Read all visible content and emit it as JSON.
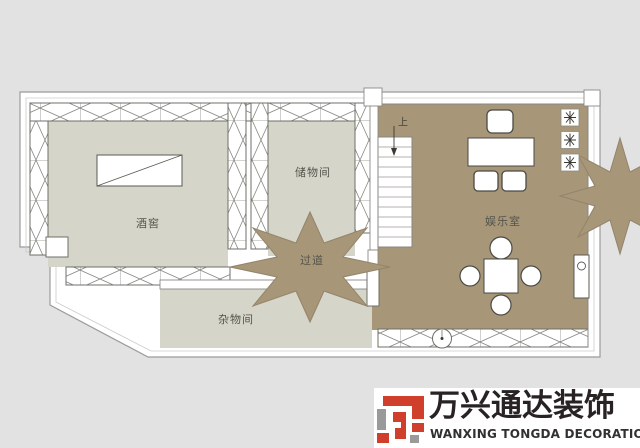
{
  "floorplan": {
    "rooms": [
      {
        "name": "wine-cellar",
        "label": "酒窖"
      },
      {
        "name": "storage-room",
        "label": "储物间"
      },
      {
        "name": "hallway",
        "label": "过道"
      },
      {
        "name": "recreation-room",
        "label": "娱乐室"
      },
      {
        "name": "utility-room",
        "label": "杂物间"
      }
    ],
    "stairs_label": "上",
    "colors": {
      "background": "#e2e2e3",
      "floor_light": "#d6d5c9",
      "floor_tan": "#a79677",
      "wall_line": "#6f6f68"
    }
  },
  "branding": {
    "company_name_cn": "万兴通达装饰",
    "company_name_en": "WANXING TONGDA DECORATION",
    "brand_red": "#cf3f2c",
    "brand_gray": "#9a9a9a"
  }
}
